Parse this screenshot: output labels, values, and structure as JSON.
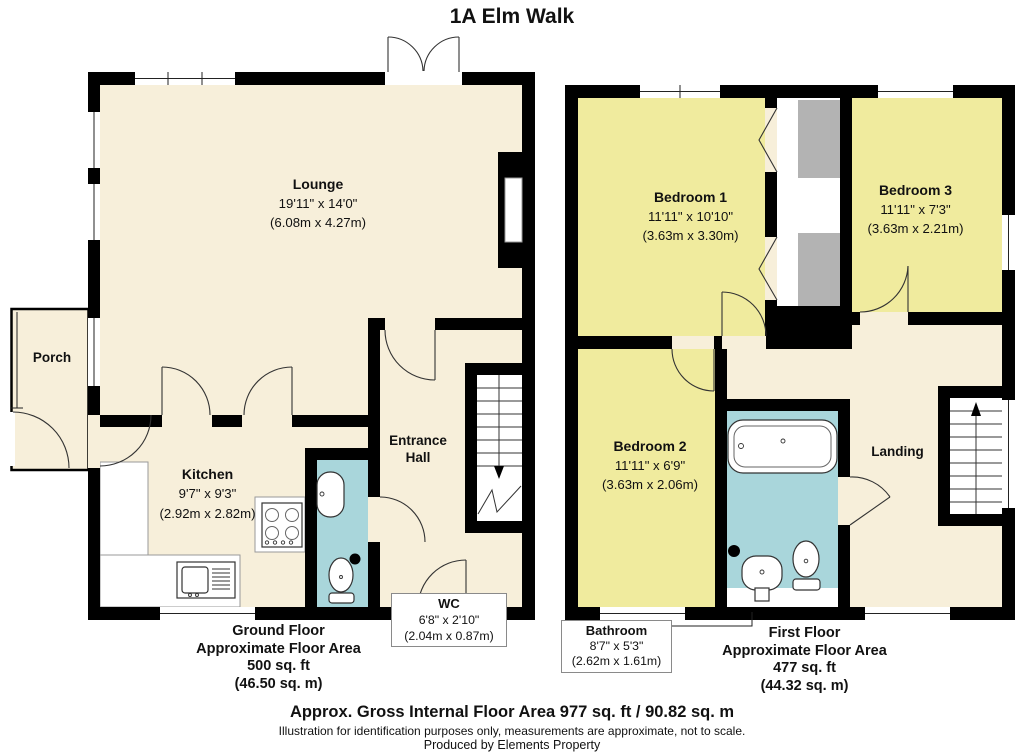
{
  "title": "1A Elm Walk",
  "colors": {
    "room_cream": "#F7EFDA",
    "room_yellow": "#F0EB9E",
    "room_teal": "#A9D6DB",
    "cupboard_grey": "#B3B3B3",
    "wall": "#000000"
  },
  "rooms": {
    "lounge": {
      "name": "Lounge",
      "imp": "19'11\" x 14'0\"",
      "met": "(6.08m x 4.27m)"
    },
    "porch": {
      "name": "Porch"
    },
    "kitchen": {
      "name": "Kitchen",
      "imp": "9'7\" x 9'3\"",
      "met": "(2.92m x 2.82m)"
    },
    "hall": {
      "name": "Entrance Hall"
    },
    "wc": {
      "name": "WC",
      "imp": "6'8\" x 2'10\"",
      "met": "(2.04m x 0.87m)"
    },
    "bedroom1": {
      "name": "Bedroom 1",
      "imp": "11'11\" x 10'10\"",
      "met": "(3.63m x 3.30m)"
    },
    "bedroom2": {
      "name": "Bedroom 2",
      "imp": "11'11\" x 6'9\"",
      "met": "(3.63m x 2.06m)"
    },
    "bedroom3": {
      "name": "Bedroom 3",
      "imp": "11'11\" x 7'3\"",
      "met": "(3.63m x 2.21m)"
    },
    "bathroom": {
      "name": "Bathroom",
      "imp": "8'7\" x 5'3\"",
      "met": "(2.62m x 1.61m)"
    },
    "landing": {
      "name": "Landing"
    }
  },
  "ground_area": {
    "floor": "Ground Floor",
    "label": "Approximate Floor Area",
    "sqft": "500 sq. ft",
    "sqm": "(46.50 sq. m)"
  },
  "first_area": {
    "floor": "First Floor",
    "label": "Approximate Floor Area",
    "sqft": "477 sq. ft",
    "sqm": "(44.32 sq. m)"
  },
  "footer": {
    "gross_area": "Approx. Gross Internal Floor Area 977 sq. ft / 90.82 sq. m",
    "disclaimer": "Illustration for identification purposes only, measurements are approximate, not to scale.",
    "producer": "Produced by Elements Property"
  }
}
